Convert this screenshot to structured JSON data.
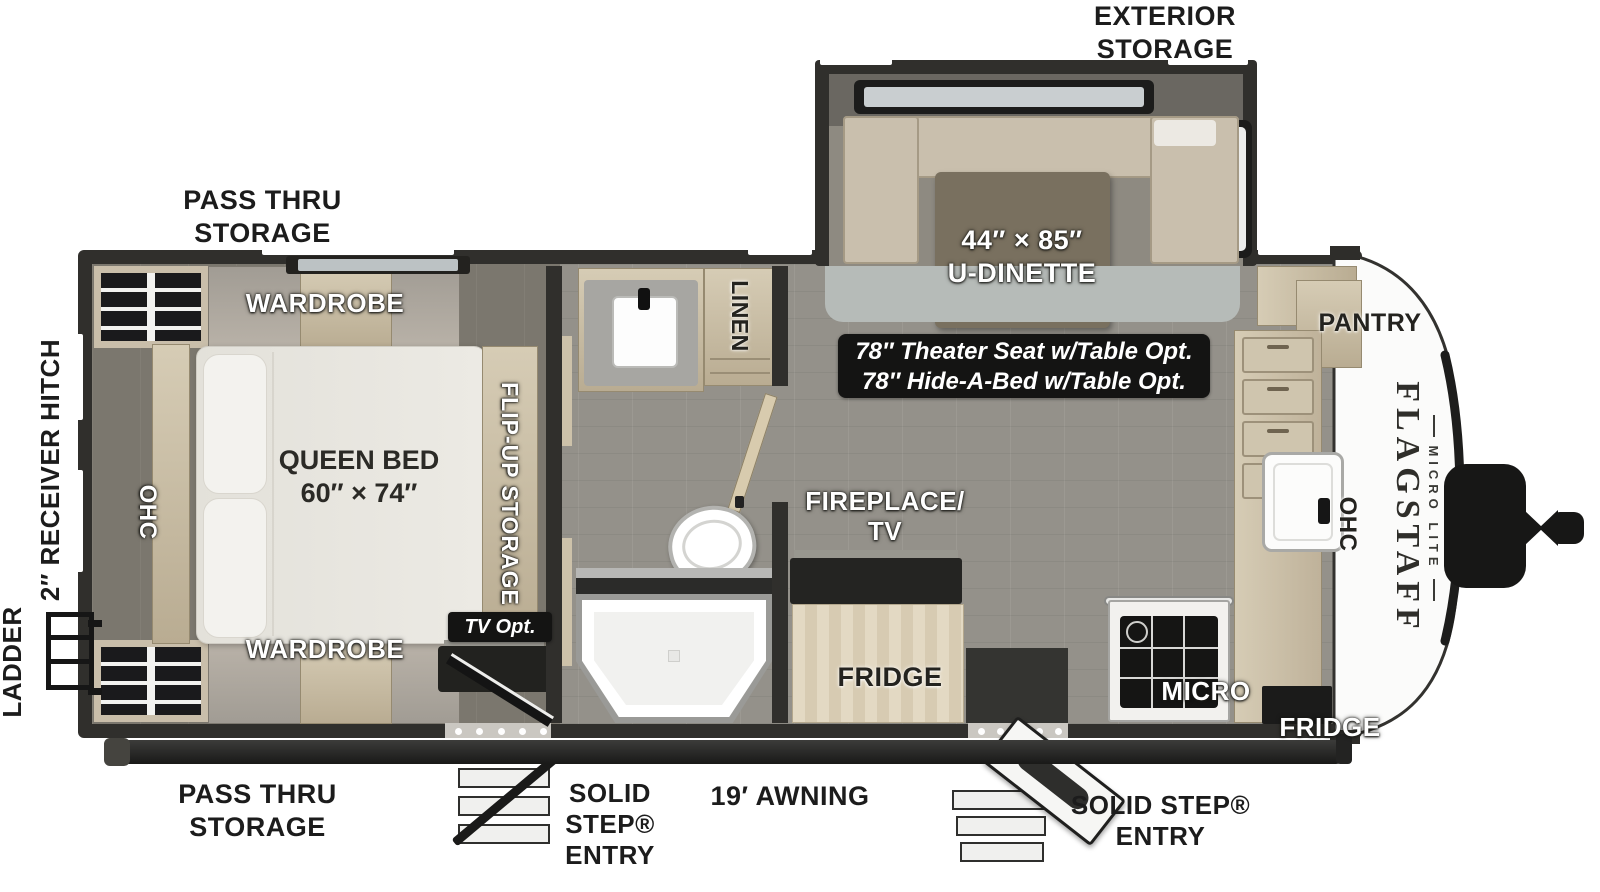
{
  "floorplan": {
    "brand": {
      "title": "FLAGSTAFF",
      "subtitle": "MICRO LITE"
    },
    "exterior_labels": {
      "exterior_storage": [
        "EXTERIOR",
        "STORAGE"
      ],
      "pass_thru_top": [
        "PASS THRU",
        "STORAGE"
      ],
      "pass_thru_bottom": [
        "PASS THRU",
        "STORAGE"
      ],
      "ladder": "LADDER",
      "receiver_hitch": "2″ RECEIVER HITCH",
      "awning": "19′ AWNING",
      "solid_step_left": [
        "SOLID",
        "STEP®",
        "ENTRY"
      ],
      "solid_step_right": [
        "SOLID STEP®",
        "ENTRY"
      ]
    },
    "interior_labels": {
      "wardrobe_top": "WARDROBE",
      "wardrobe_bottom": "WARDROBE",
      "queen_bed": [
        "QUEEN BED",
        "60″ × 74″"
      ],
      "ohc_bedroom": "OHC",
      "flip_up_storage": "FLIP-UP STORAGE",
      "tv_opt": "TV Opt.",
      "linen": "LINEN",
      "fireplace_tv": [
        "FIREPLACE/",
        "TV"
      ],
      "fridge_main": "FRIDGE",
      "dinette": [
        "44″ × 85″",
        "U-DINETTE"
      ],
      "dinette_options": [
        "78″ Theater Seat w/Table Opt.",
        "78″ Hide-A-Bed w/Table Opt."
      ],
      "pantry": "PANTRY",
      "ohc_kitchen": "OHC",
      "micro": "MICRO",
      "fridge_front": "FRIDGE"
    },
    "colors": {
      "wall": "#302f2c",
      "cabinet": "#cdc3ac",
      "floor": "#94918a",
      "bedroom_floor": "#7b776e",
      "callout_box": "#141413",
      "accent_white": "#ffffff"
    }
  }
}
